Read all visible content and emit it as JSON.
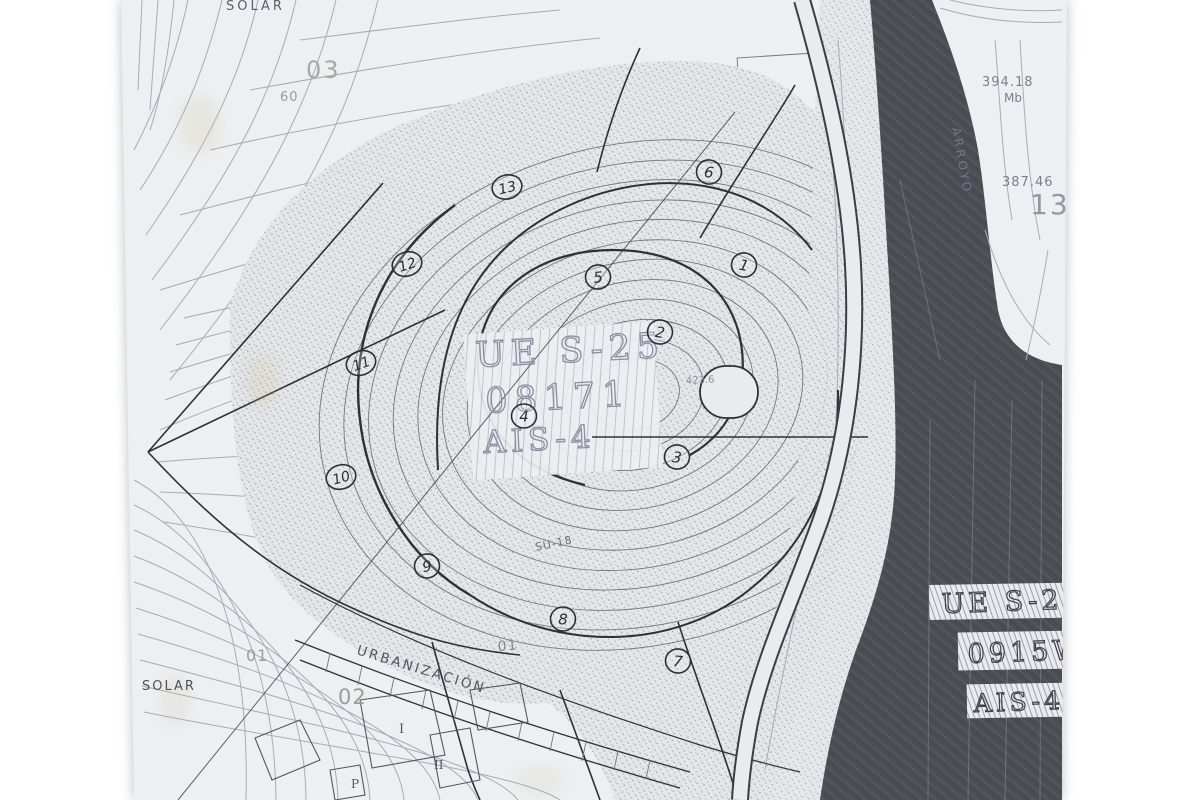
{
  "page": {
    "background": "#ffffff",
    "description": "Scanned photocopy of a cadastral / urban-planning contour map with hand-drawn parcel numbers"
  },
  "map": {
    "colors": {
      "paper": "#edeff3",
      "contour_light": "#a9abb5",
      "contour_mid": "#74767f",
      "line_dark": "#2f3036",
      "river_dark": "#4d4d54",
      "label_gray": "#8b8ea0",
      "stain_yellow": "#cfc49a"
    },
    "center_block": {
      "line1": "UE S-25",
      "line2": "08171",
      "line3": "AIS-4"
    },
    "right_boxes": {
      "line1": "UE S-2",
      "line2": "0915W",
      "line3": "AIS-4"
    },
    "labels": [
      {
        "id": "solar-top",
        "text": "SOLAR",
        "x": 226,
        "y": 10,
        "size": 13,
        "rot": 0,
        "color": "#5c5e69",
        "ls": 3
      },
      {
        "id": "ref-03",
        "text": "03",
        "x": 306,
        "y": 78,
        "size": 24,
        "rot": 0,
        "color": "#a9a9a1",
        "ls": 2
      },
      {
        "id": "ref-60",
        "text": "60",
        "x": 280,
        "y": 101,
        "size": 13,
        "rot": 0,
        "color": "#9b9b93",
        "ls": 1
      },
      {
        "id": "elev-394",
        "text": "394.18",
        "x": 982,
        "y": 86,
        "size": 13,
        "rot": 0,
        "color": "#7d7f8a",
        "ls": 1
      },
      {
        "id": "elev-mb",
        "text": "Mb",
        "x": 1004,
        "y": 102,
        "size": 12,
        "rot": 0,
        "color": "#7d7f8a",
        "ls": 0
      },
      {
        "id": "elev-387",
        "text": "387.46",
        "x": 1002,
        "y": 186,
        "size": 13,
        "rot": 0,
        "color": "#7d7f8a",
        "ls": 1
      },
      {
        "id": "ref-13",
        "text": "13",
        "x": 1030,
        "y": 214,
        "size": 28,
        "rot": 0,
        "color": "#9597a2",
        "ls": 2
      },
      {
        "id": "arroyo",
        "text": "ARROYO",
        "x": 952,
        "y": 128,
        "size": 12,
        "rot": 80,
        "color": "#74768a",
        "ls": 3
      },
      {
        "id": "su-18",
        "text": "SU-18",
        "x": 536,
        "y": 551,
        "size": 11,
        "rot": -12,
        "color": "#6c6e79",
        "ls": 1
      },
      {
        "id": "elev-423",
        "text": "423.6",
        "x": 686,
        "y": 384,
        "size": 10,
        "rot": -3,
        "color": "#8e909b",
        "ls": 0
      },
      {
        "id": "solar-left",
        "text": "SOLAR",
        "x": 142,
        "y": 690,
        "size": 13,
        "rot": 0,
        "color": "#4e505b",
        "ls": 2
      },
      {
        "id": "ref-01a",
        "text": "01",
        "x": 246,
        "y": 661,
        "size": 16,
        "rot": 0,
        "color": "#9b9d97",
        "ls": 1
      },
      {
        "id": "ref-02",
        "text": "02",
        "x": 338,
        "y": 704,
        "size": 21,
        "rot": 0,
        "color": "#9b9d97",
        "ls": 1
      },
      {
        "id": "ref-01b",
        "text": "01",
        "x": 498,
        "y": 651,
        "size": 14,
        "rot": -4,
        "color": "#85878d",
        "ls": 1
      },
      {
        "id": "urbanizacion",
        "text": "URBANIZACIÓN",
        "x": 356,
        "y": 654,
        "size": 13.5,
        "rot": 17,
        "color": "#53555e",
        "ls": 2.5
      },
      {
        "id": "block-i",
        "text": "I",
        "x": 399,
        "y": 733,
        "size": 13,
        "rot": 0,
        "color": "#55575f",
        "ls": 0,
        "cls": "serif"
      },
      {
        "id": "block-ii",
        "text": "II",
        "x": 434,
        "y": 769,
        "size": 12,
        "rot": 0,
        "color": "#55575f",
        "ls": 0,
        "cls": "serif"
      },
      {
        "id": "block-p",
        "text": "P",
        "x": 351,
        "y": 788,
        "size": 12,
        "rot": 0,
        "color": "#55575f",
        "ls": 0,
        "cls": "serif"
      },
      {
        "id": "center-ue-s-25",
        "text": "UE S-25",
        "x": 476,
        "y": 367,
        "size": 35,
        "rot": -3,
        "color": "#8b8ea0",
        "ls": 6,
        "cls": "outline-big"
      },
      {
        "id": "center-08171",
        "text": "08171",
        "x": 486,
        "y": 413,
        "size": 35,
        "rot": -3,
        "color": "#8b8ea0",
        "ls": 7,
        "cls": "outline-big"
      },
      {
        "id": "center-ais-4",
        "text": "AIS-4",
        "x": 484,
        "y": 453,
        "size": 31,
        "rot": -3,
        "color": "#8b8ea0",
        "ls": 5,
        "cls": "outline-big"
      },
      {
        "id": "box-ue-s-2",
        "text": "UE S-2",
        "x": 942,
        "y": 613,
        "size": 27,
        "rot": -2,
        "color": "#3f404a",
        "ls": 4,
        "cls": "outline-box"
      },
      {
        "id": "box-0915w",
        "text": "0915W",
        "x": 968,
        "y": 663,
        "size": 27,
        "rot": -2,
        "color": "#3f404a",
        "ls": 4,
        "cls": "outline-box"
      },
      {
        "id": "box-ais-4",
        "text": "AIS-4",
        "x": 974,
        "y": 712,
        "size": 25,
        "rot": -2,
        "color": "#3f404a",
        "ls": 4,
        "cls": "outline-box"
      }
    ],
    "parcels": [
      {
        "n": "13",
        "x": 507,
        "y": 187,
        "r": -14
      },
      {
        "n": "6",
        "x": 709,
        "y": 172,
        "r": 8
      },
      {
        "n": "12",
        "x": 407,
        "y": 264,
        "r": -18
      },
      {
        "n": "5",
        "x": 598,
        "y": 277,
        "r": -6
      },
      {
        "n": "1",
        "x": 744,
        "y": 265,
        "r": 12
      },
      {
        "n": "2",
        "x": 660,
        "y": 332,
        "r": 10
      },
      {
        "n": "11",
        "x": 361,
        "y": 363,
        "r": -20
      },
      {
        "n": "4",
        "x": 524,
        "y": 416,
        "r": 0
      },
      {
        "n": "3",
        "x": 677,
        "y": 457,
        "r": 6
      },
      {
        "n": "10",
        "x": 341,
        "y": 477,
        "r": -16
      },
      {
        "n": "9",
        "x": 427,
        "y": 566,
        "r": -8
      },
      {
        "n": "8",
        "x": 563,
        "y": 619,
        "r": 0
      },
      {
        "n": "7",
        "x": 678,
        "y": 661,
        "r": 6
      }
    ]
  }
}
